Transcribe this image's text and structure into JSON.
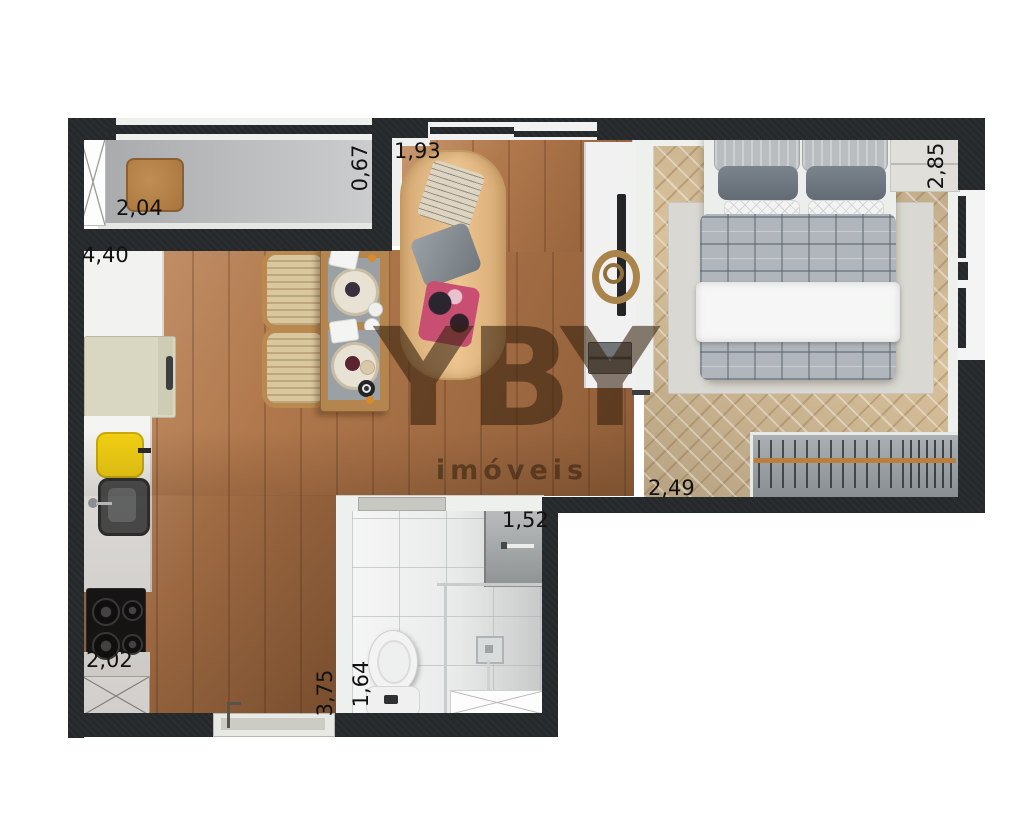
{
  "brand": {
    "logo": "YBY",
    "subtitle": "imóveis"
  },
  "dimensions": {
    "balcony_width": "2,04",
    "living_width": "4,40",
    "balcony_recess": "0,67",
    "living_window": "1,93",
    "bedroom_depth": "2,85",
    "bedroom_width": "2,49",
    "bathroom_width": "1,52",
    "bathroom_depth": "1,64",
    "living_depth": "3,75",
    "kitchen_wall": "2,02"
  },
  "colors": {
    "wall": "#26292b",
    "living_floor": "#b1784c",
    "bedroom_floor": "#d9c19b",
    "balcony_floor": "#b9bbbc",
    "bathroom_floor": "#e9ebea",
    "kettle_accent": "#f2d013",
    "wardrobe_rail": "#b97f3e",
    "watermark": "rgba(54,33,14,0.58)"
  }
}
